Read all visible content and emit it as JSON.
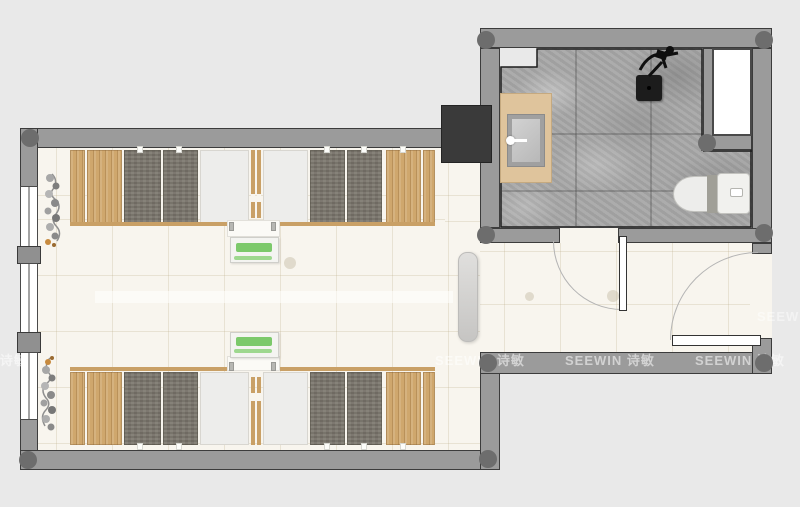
{
  "watermark": {
    "text": "SEEWIN 诗敏"
  },
  "colors": {
    "background": "#e9e9e9",
    "wall": "#9b9b9b",
    "wall_outline": "#2f2f2f",
    "column_marker": "#6d6d6d",
    "floor": "#f8f5ee",
    "bathroom_tile": "#a8a8a8",
    "wood": "#cfa76d",
    "mattress_gray": "#7b766c",
    "desk_white": "#ededeb",
    "frame_tan": "#c9a066",
    "bench_green": "#7cc96b",
    "cabinet_dark": "#3a3a3a",
    "counter_tan": "#dfc49c",
    "fixture_black": "#1c1c1c",
    "door_arc": "#b4b4b4",
    "porcelain": "#efefec"
  }
}
